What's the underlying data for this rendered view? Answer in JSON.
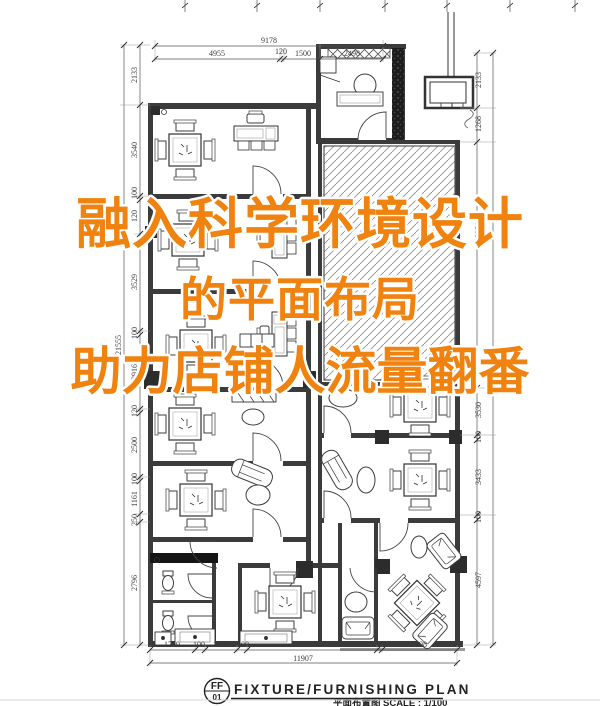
{
  "overlay": {
    "color": "#f0820f",
    "lines": [
      "融入科学环境设计",
      "的平面布局",
      "助力店铺人流量翻番"
    ]
  },
  "dims": {
    "top": {
      "total": "9178",
      "segments": [
        "4955",
        "120",
        "1500",
        "2498"
      ]
    },
    "bottom": {
      "total": "11907",
      "segments": [
        "1759",
        "100",
        "1500",
        "100",
        "5390",
        "100",
        "2898"
      ]
    },
    "left": {
      "total": "21555",
      "segments": [
        "2133",
        "3540",
        "100",
        "120",
        "3529",
        "100",
        "2916",
        "120",
        "2500",
        "100",
        "1161",
        "250",
        "2796"
      ]
    },
    "right": {
      "segments": [
        "2133",
        "1268",
        "8371",
        "3530",
        "100",
        "3433",
        "100",
        "4597"
      ]
    }
  },
  "title_block": {
    "sheet_code": "FF",
    "sheet_number": "01",
    "title": "FIXTURE/FURNISHING PLAN",
    "title_cn": "平面布置图",
    "scale": "SCALE : 1/100"
  }
}
